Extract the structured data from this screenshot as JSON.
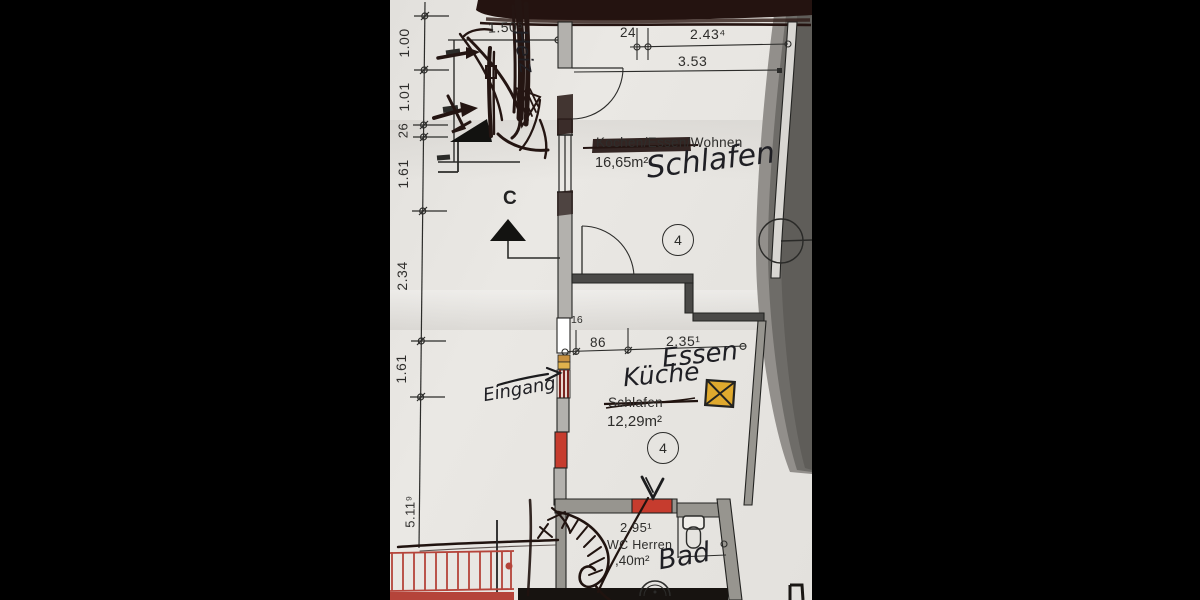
{
  "photo": {
    "description": "hand-annotated architectural floor plan photographed on dark background",
    "colors": {
      "paper": "#e8e6e2",
      "print_ink": "#2e2d2b",
      "wall_fill": "#97958f",
      "red_accent": "#c24335",
      "yellow_window": "#dfa92e",
      "pen_scribble": "#241412",
      "photo_backdrop_grey": "#6e6c68"
    }
  },
  "left_dimensions": {
    "values": [
      "1.00",
      "1.01",
      "26",
      "1.61",
      "2.34",
      "1.61",
      "5.11⁹"
    ]
  },
  "stairwell": {
    "dim": "1.50⁵",
    "handwritten_label": "Heiz"
  },
  "section_marker": {
    "label": "C"
  },
  "entrance": {
    "handwritten_label": "Eingang"
  },
  "top_room": {
    "dim_24": "24",
    "dim_243": "2.43⁴",
    "dim_353": "3.53",
    "printed_name": "Kochen/Essen/Wohnen",
    "area": "16,65m²",
    "handwritten_name": "Schlafen",
    "room_number": "4"
  },
  "kitchen_room": {
    "dim_16": "16",
    "dim_86": "86",
    "dim_235": "2.35¹",
    "handwritten_essen": "Essen",
    "handwritten_kueche": "Küche",
    "printed_name_struck": "Schlafen",
    "area": "12,29m²",
    "room_number": "4"
  },
  "bath_room": {
    "dim_295": "2.95¹",
    "printed_name": "WC Herren",
    "area": ",40m²",
    "handwritten_name": "Bad"
  }
}
